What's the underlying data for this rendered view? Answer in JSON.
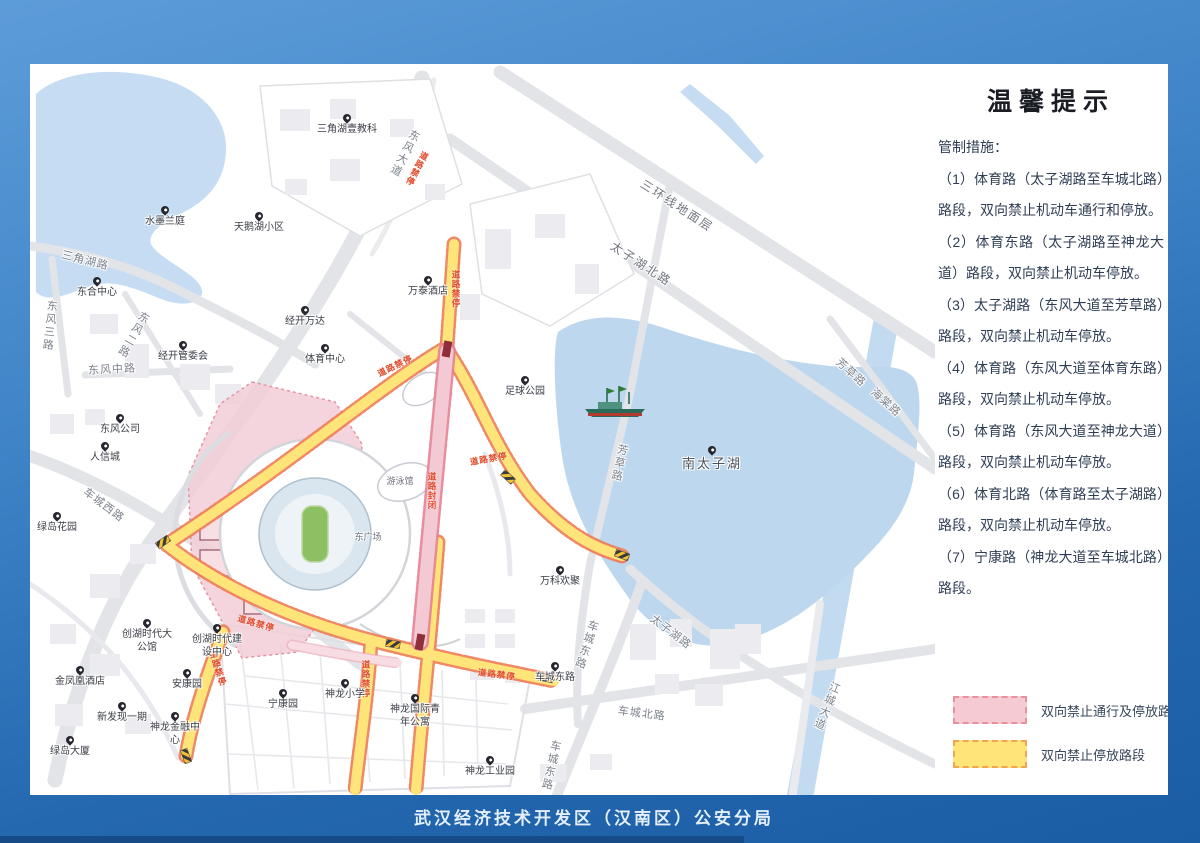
{
  "window": {
    "footer": "武汉经济技术开发区（汉南区）公安分局"
  },
  "tips": {
    "title": "温馨提示",
    "intro": "管制措施：",
    "items": [
      "（1）体育路（太子湖路至车城北路）路段，双向禁止机动车通行和停放。",
      "（2）体育东路（太子湖路至神龙大道）路段，双向禁止机动车停放。",
      "（3）太子湖路（东风大道至芳草路）路段，双向禁止机动车停放。",
      "（4）体育路（东风大道至体育东路）路段，双向禁止机动车停放。",
      "（5）体育路（东风大道至神龙大道）路段，双向禁止机动车停放。",
      "（6）体育北路（体育路至太子湖路）路段，双向禁止机动车停放。",
      "（7）宁康路（神龙大道至车城北路）路段。"
    ],
    "legend": [
      {
        "label": "双向禁止通行及停放路段",
        "fill": "#f6cad2",
        "border": "#e9909e"
      },
      {
        "label": "双向禁止停放路段",
        "fill": "#ffe478",
        "border": "#f2a355"
      }
    ]
  },
  "map": {
    "no_parking_text": "道路禁停",
    "road_closed_text": "道路封闭",
    "road_labels": [
      "三角湖路",
      "东风三路",
      "东风二路",
      "东风中路",
      "车城西路",
      "东风大道",
      "三环线地面层",
      "太子湖北路",
      "芳草路",
      "芳草路",
      "海棠路",
      "太子湖路",
      "车城东路",
      "车城北路",
      "车城东路",
      "江城大道"
    ],
    "pois": [
      "三角湖壹教科",
      "水墨兰庭",
      "天鹅湖小区",
      "东合中心",
      "经开管委会",
      "万泰酒店",
      "经开万达",
      "东风公司",
      "足球公园",
      "体育中心",
      "游泳馆",
      "东广场",
      "万科欢聚",
      "神龙小学",
      "宁康园",
      "神龙国际青年公寓",
      "车城东路",
      "神龙工业园",
      "人信城",
      "绿岛花园",
      "金凤凰酒店",
      "新发现一期",
      "安康园",
      "神龙金融中心",
      "绿岛大厦",
      "创湖时代大公馆",
      "创湖时代建设中心",
      "南太子湖"
    ],
    "colors": {
      "water": "#bdd7ee",
      "road": "#e3e4e8",
      "no_parking_fill": "#ffe47a",
      "no_parking_edge": "#ef7c55",
      "closed_fill": "#f3c9d3",
      "closed_edge": "#e77f92",
      "zone_fill": "#f3cbd4"
    }
  }
}
